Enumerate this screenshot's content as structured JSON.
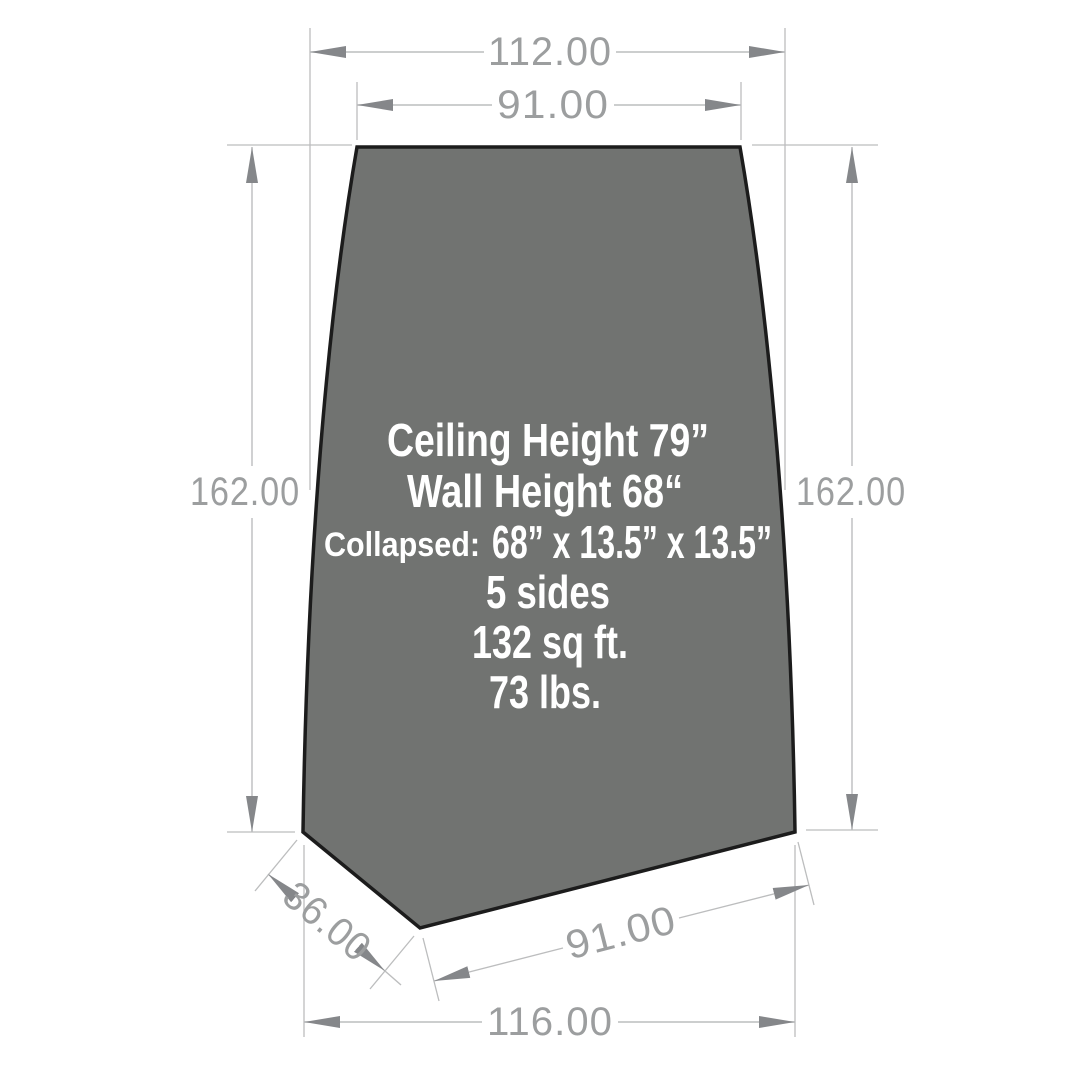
{
  "colors": {
    "background": "#ffffff",
    "shape_fill": "#717371",
    "shape_outline": "#1c1c1c",
    "dimension_line": "#bcbdbe",
    "arrow": "#85878a",
    "dimension_text": "#9c9e9f",
    "panel_text": "#ffffff"
  },
  "dimensions": {
    "top_width_outer": "112.00",
    "top_width_inner": "91.00",
    "left_height": "162.00",
    "right_height": "162.00",
    "bottom_left_edge": "36.00",
    "bottom_right_edge": "91.00",
    "bottom_width": "116.00"
  },
  "specs": {
    "ceiling_height": "Ceiling Height 79”",
    "wall_height": "Wall Height 68“",
    "collapsed_label": "Collapsed:",
    "collapsed_size": "68” x 13.5” x 13.5”",
    "sides": "5 sides",
    "area": "132 sq ft.",
    "weight": "73 lbs."
  }
}
